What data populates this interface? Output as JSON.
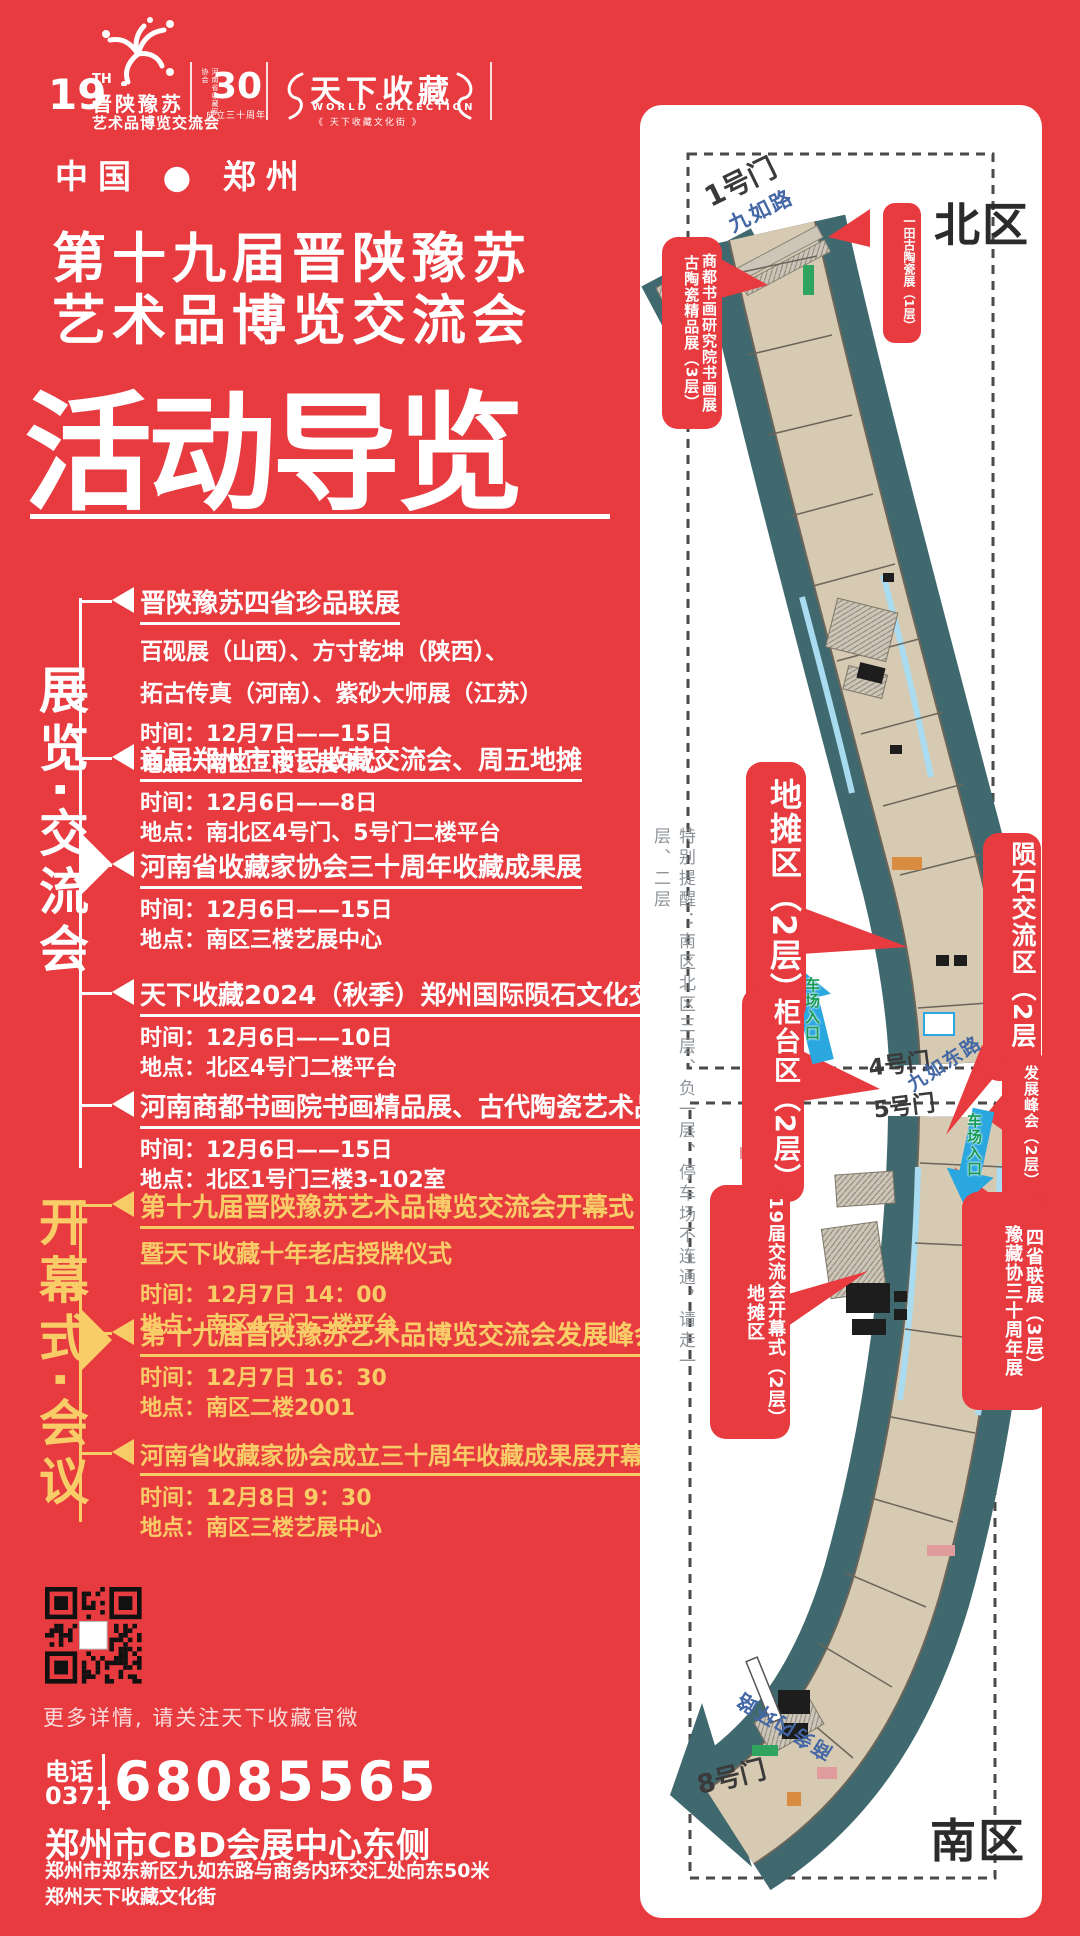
{
  "colors": {
    "bg": "#e73b3f",
    "gold": "#f8cd68",
    "teal": "#40696f",
    "beige": "#d6cab2",
    "light_blue": "#a9dcf0",
    "road_blue": "#4467a5",
    "arrow_blue": "#2ba7e0",
    "arrow_green": "#159a52",
    "ink": "#2b2b2b",
    "note_gray": "#8e9499"
  },
  "header": {
    "expo_logo": {
      "number": "19",
      "suffix": "TH",
      "line1": "晋陕豫苏",
      "line2": "艺术品博览交流会"
    },
    "anniv_logo": {
      "number": "30",
      "side_text": "河南省收藏家协会",
      "caption": "成立三十周年"
    },
    "collection_logo": {
      "title": "天下收藏",
      "subtitle": "WORLD COLLECTION",
      "tagline": "《 天下收藏文化街 》"
    }
  },
  "title": {
    "kicker": "中国 ● 郑州",
    "line1": "第十九届晋陕豫苏",
    "line2": "艺术品博览交流会",
    "headline": "活动导览"
  },
  "sections": [
    {
      "label": "展览·交流会",
      "events": [
        {
          "title": "晋陕豫苏四省珍品联展",
          "desc1": "百砚展（山西）、方寸乾坤（陕西）、",
          "desc2": "拓古传真（河南）、紫砂大师展（江苏）",
          "time": "时间：12月7日——15日",
          "place": "地点：南区三楼艺展中心"
        },
        {
          "title": "首届郑州市市民收藏交流会、周五地摊",
          "time": "时间：12月6日——8日",
          "place": "地点：南北区4号门、5号门二楼平台"
        },
        {
          "title": "河南省收藏家协会三十周年收藏成果展",
          "time": "时间：12月6日——15日",
          "place": "地点：南区三楼艺展中心"
        },
        {
          "title": "天下收藏2024（秋季）郑州国际陨石文化交流大会",
          "time": "时间：12月6日——10日",
          "place": "地点：北区4号门二楼平台"
        },
        {
          "title": "河南商都书画院书画精品展、古代陶瓷艺术品精品展",
          "time": "时间：12月6日——15日",
          "place": "地点：北区1号门三楼3-102室"
        }
      ]
    },
    {
      "label": "开幕式·会议",
      "events": [
        {
          "title": "第十九届晋陕豫苏艺术品博览交流会开幕式",
          "subtitle": "暨天下收藏十年老店授牌仪式",
          "time": "时间：12月7日 14：00",
          "place": "地点：南区4号门二楼平台"
        },
        {
          "title": "第十九届晋陕豫苏艺术品博览交流会发展峰会",
          "time": "时间：12月7日 16：30",
          "place": "地点：南区二楼2001"
        },
        {
          "title": "河南省收藏家协会成立三十周年收藏成果展开幕式暨2025年年会",
          "time": "时间：12月8日 9：30",
          "place": "地点：南区三楼艺展中心"
        }
      ]
    }
  ],
  "footer": {
    "qr_caption": "更多详情, 请关注天下收藏官微",
    "phone_label": "电话",
    "area_code": "0371",
    "phone_number": "68085565",
    "address_title": "郑州市CBD会展中心东侧",
    "address_line1": "郑州市郑东新区九如东路与商务内环交汇处向东50米",
    "address_line2": "郑州天下收藏文化街"
  },
  "map": {
    "north_label": "北区",
    "south_label": "南区",
    "note": "特别提醒：南区北区三层、负一层、停车场不连通，请走一层、二层",
    "gate1": "1号门",
    "gate4": "4号门",
    "gate5": "5号门",
    "gate8": "8号门",
    "road_north": "九如路",
    "road_middle": "九如东路",
    "road_south": "商务内环路",
    "parking_entrance": "车场入口",
    "callouts": [
      {
        "cols": [
          "商都书画研究院书画展",
          "古陶瓷精品展（3层）"
        ]
      },
      {
        "cols": [
          "一田古陶瓷展（1层）"
        ]
      },
      {
        "cols": [
          "地摊区（2层）"
        ]
      },
      {
        "cols": [
          "陨石交流区（2层）"
        ]
      },
      {
        "cols": [
          "柜台区（2层）"
        ]
      },
      {
        "cols": [
          "发展峰会（2层）"
        ]
      },
      {
        "cols": [
          "19届交流会开幕式（2层）",
          "地摊区"
        ]
      },
      {
        "cols": [
          "四省联展（3层）",
          "豫藏协三十周年展"
        ]
      }
    ]
  }
}
